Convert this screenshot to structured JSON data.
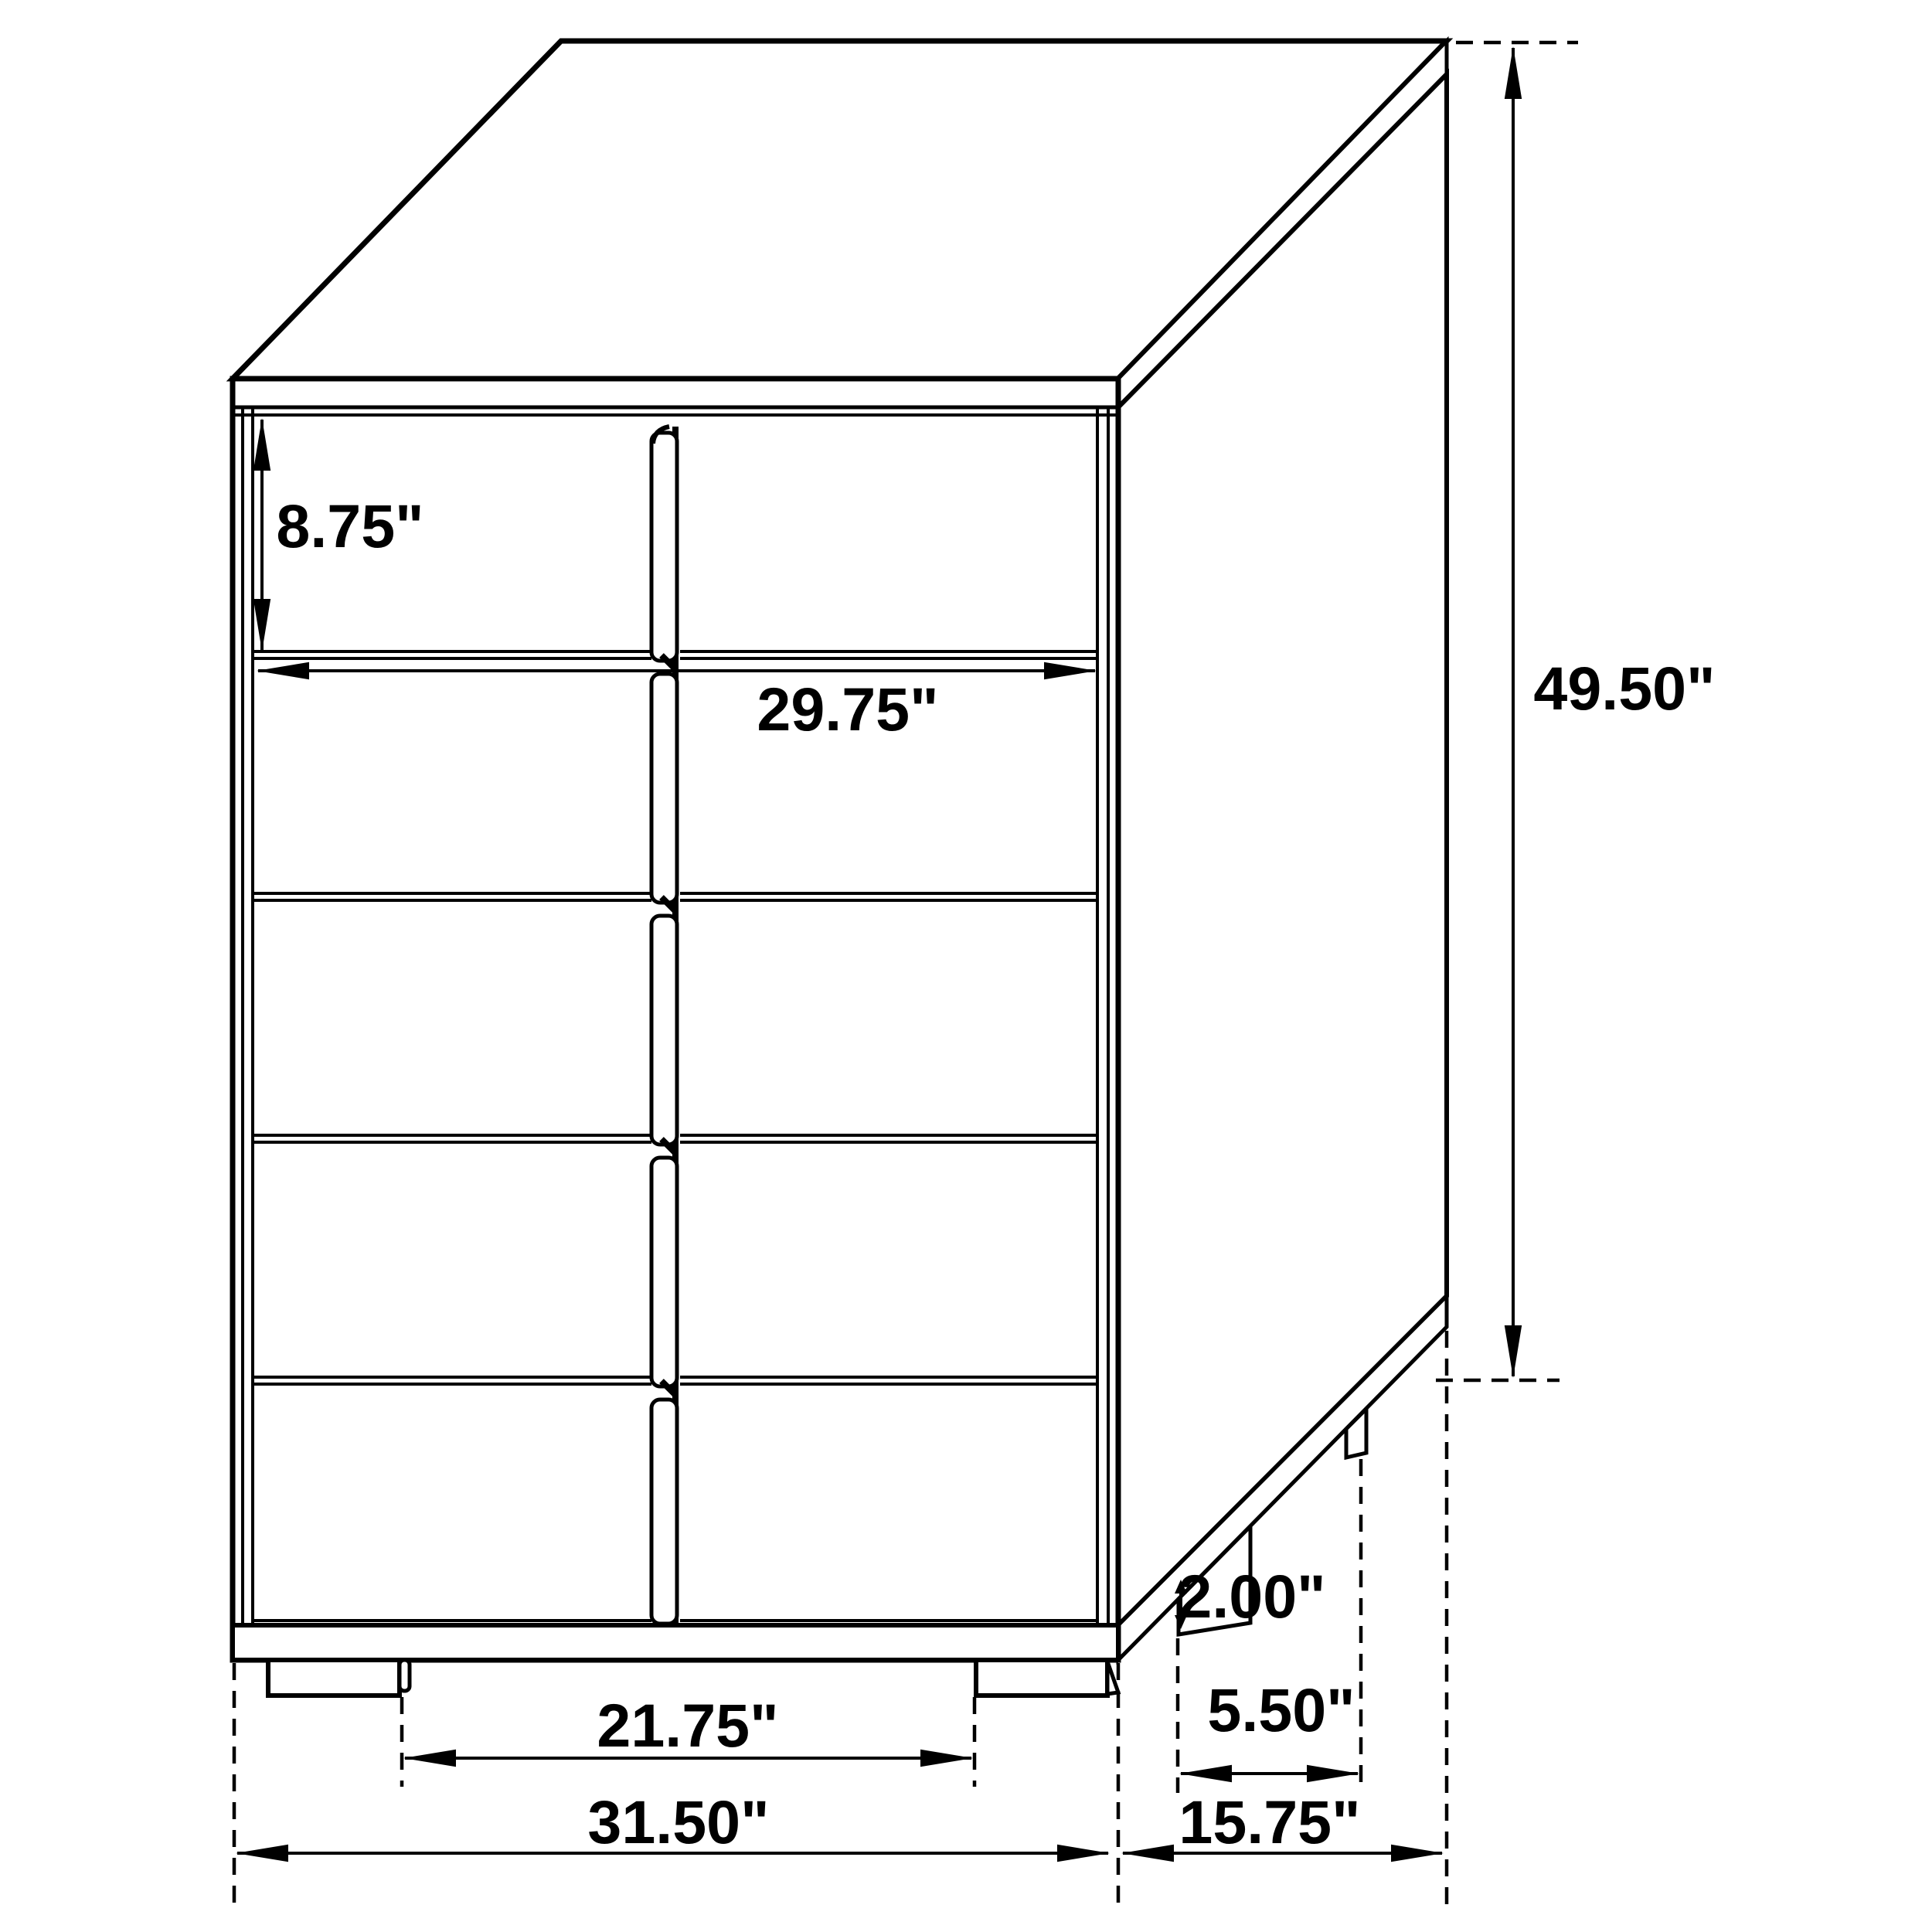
{
  "page": {
    "background_color": "#ffffff",
    "line_color": "#000000",
    "text_color": "#000000"
  },
  "drawing": {
    "kind": "furniture dimension diagram",
    "subject": "5-drawer chest, isometric line drawing with dimension callouts"
  },
  "dims": {
    "drawer_height": {
      "label": "8.75\""
    },
    "drawer_width": {
      "label": "29.75\""
    },
    "overall_height": {
      "label": "49.50\""
    },
    "foot_height": {
      "label": "2.00\""
    },
    "side_foot_spacing": {
      "label": "5.50\""
    },
    "front_feet_spacing": {
      "label": "21.75\""
    },
    "overall_width": {
      "label": "31.50\""
    },
    "overall_depth": {
      "label": "15.75\""
    }
  }
}
